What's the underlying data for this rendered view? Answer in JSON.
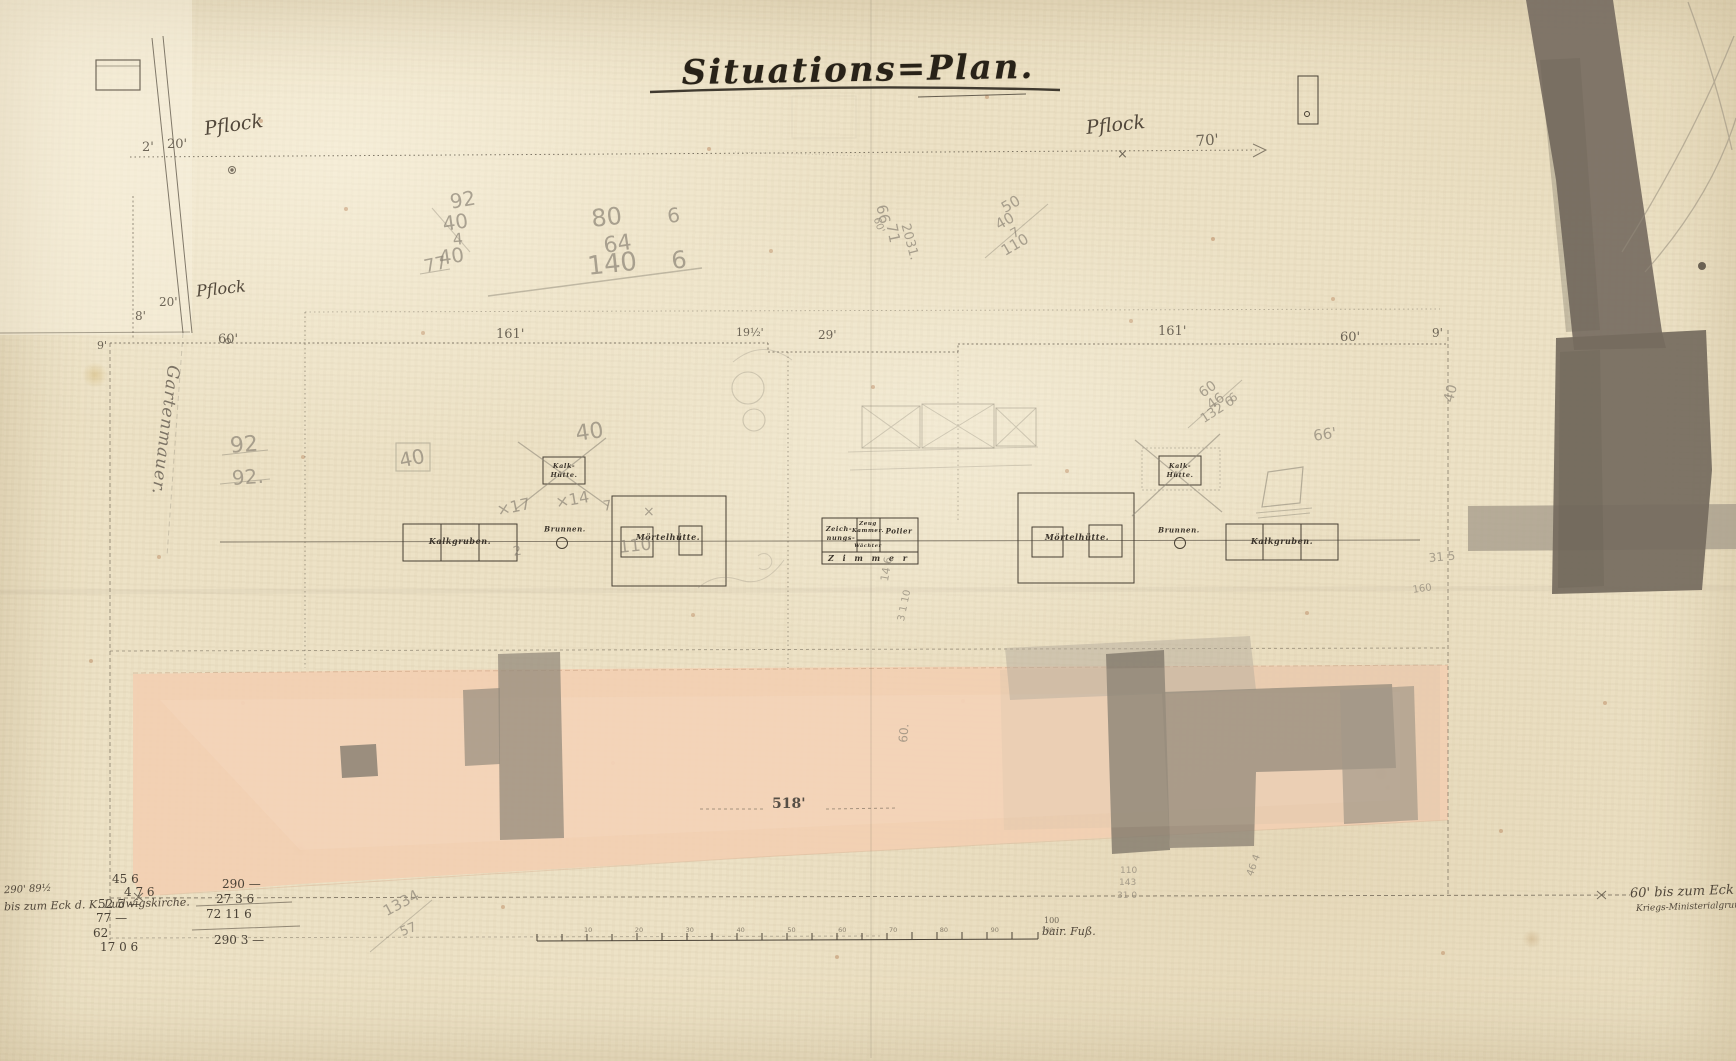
{
  "title": "Situations=Plan.",
  "pflock": {
    "left_a": "2'",
    "left_b": "20'",
    "left_label": "Pflock",
    "left2_a": "20'",
    "left2_label": "Pflock",
    "left2_b": "8'",
    "right_label": "Pflock",
    "right_mark": "×",
    "right_dist": "70'"
  },
  "dims": [
    "9'",
    "60'",
    "161'",
    "19½'",
    "29'",
    "161'",
    "60'",
    "9'"
  ],
  "buildings": {
    "kalkgruben_left": "Kalkgruben.",
    "brunnen_left": "Brunnen.",
    "moertel_left": "Mörtelhütte.",
    "kalkhuette_l1": "Kalk-",
    "kalkhuette_l2": "Hütte.",
    "zeich1": "Zeich-",
    "zeich2": "nungs-",
    "zeug1": "Zeug",
    "zeug2": "Kammer.",
    "waechter": "Wächter",
    "polier": "Polier",
    "zimmer": "Z i m m e r",
    "moertel_right": "Mörtelhütte.",
    "brunnen_right": "Brunnen.",
    "kalkgruben_right": "Kalkgruben.",
    "kalkhuette_r1": "Kalk-",
    "kalkhuette_r2": "Hütte."
  },
  "band": {
    "length_label": "518'"
  },
  "inscriptions": {
    "bl1": "290' 89½",
    "bl2": "bis zum Eck d. K. Ludwigskirche.",
    "br1": "60' bis zum Eck des",
    "br2": "Kriegs-Ministerialgrunds.",
    "margin_script": "Gartenmauer."
  },
  "calc": {
    "left": [
      "45 6",
      "4 7 6",
      "52 5 —",
      "77 —",
      "62",
      "17 0 6"
    ],
    "right": [
      "290 —",
      "27 3 6",
      "72 11 6",
      "290 3 —"
    ]
  },
  "scale": {
    "caption_top": "100",
    "caption": "bair. Fuß.",
    "ticks": [
      "10",
      "20",
      "30",
      "40",
      "50",
      "60",
      "70",
      "80",
      "90",
      "100"
    ]
  },
  "pencil": [
    "92",
    "40",
    "4",
    "40",
    "80",
    "6",
    "64",
    "140",
    "6",
    "77",
    "92",
    "92.",
    "40",
    "40",
    "×17",
    "×14",
    "7",
    "×",
    "110",
    "2",
    "66",
    "71",
    "2031.",
    "60'",
    "50",
    "40",
    "7",
    "110",
    "60",
    "46",
    "6",
    "132 6",
    "66'",
    "40",
    "31 5",
    "160",
    "14 6",
    "3 1 10",
    "60.",
    "1334",
    "57",
    "110",
    "143",
    "31 0",
    "46 4"
  ],
  "colors": {
    "paper": "#ede2c6",
    "pink_band": "#f2cfb2",
    "dark_patch": "#776e61",
    "light_patch": "#a89d8c",
    "ink": "#413a2e",
    "pencil": "#8d8578"
  }
}
